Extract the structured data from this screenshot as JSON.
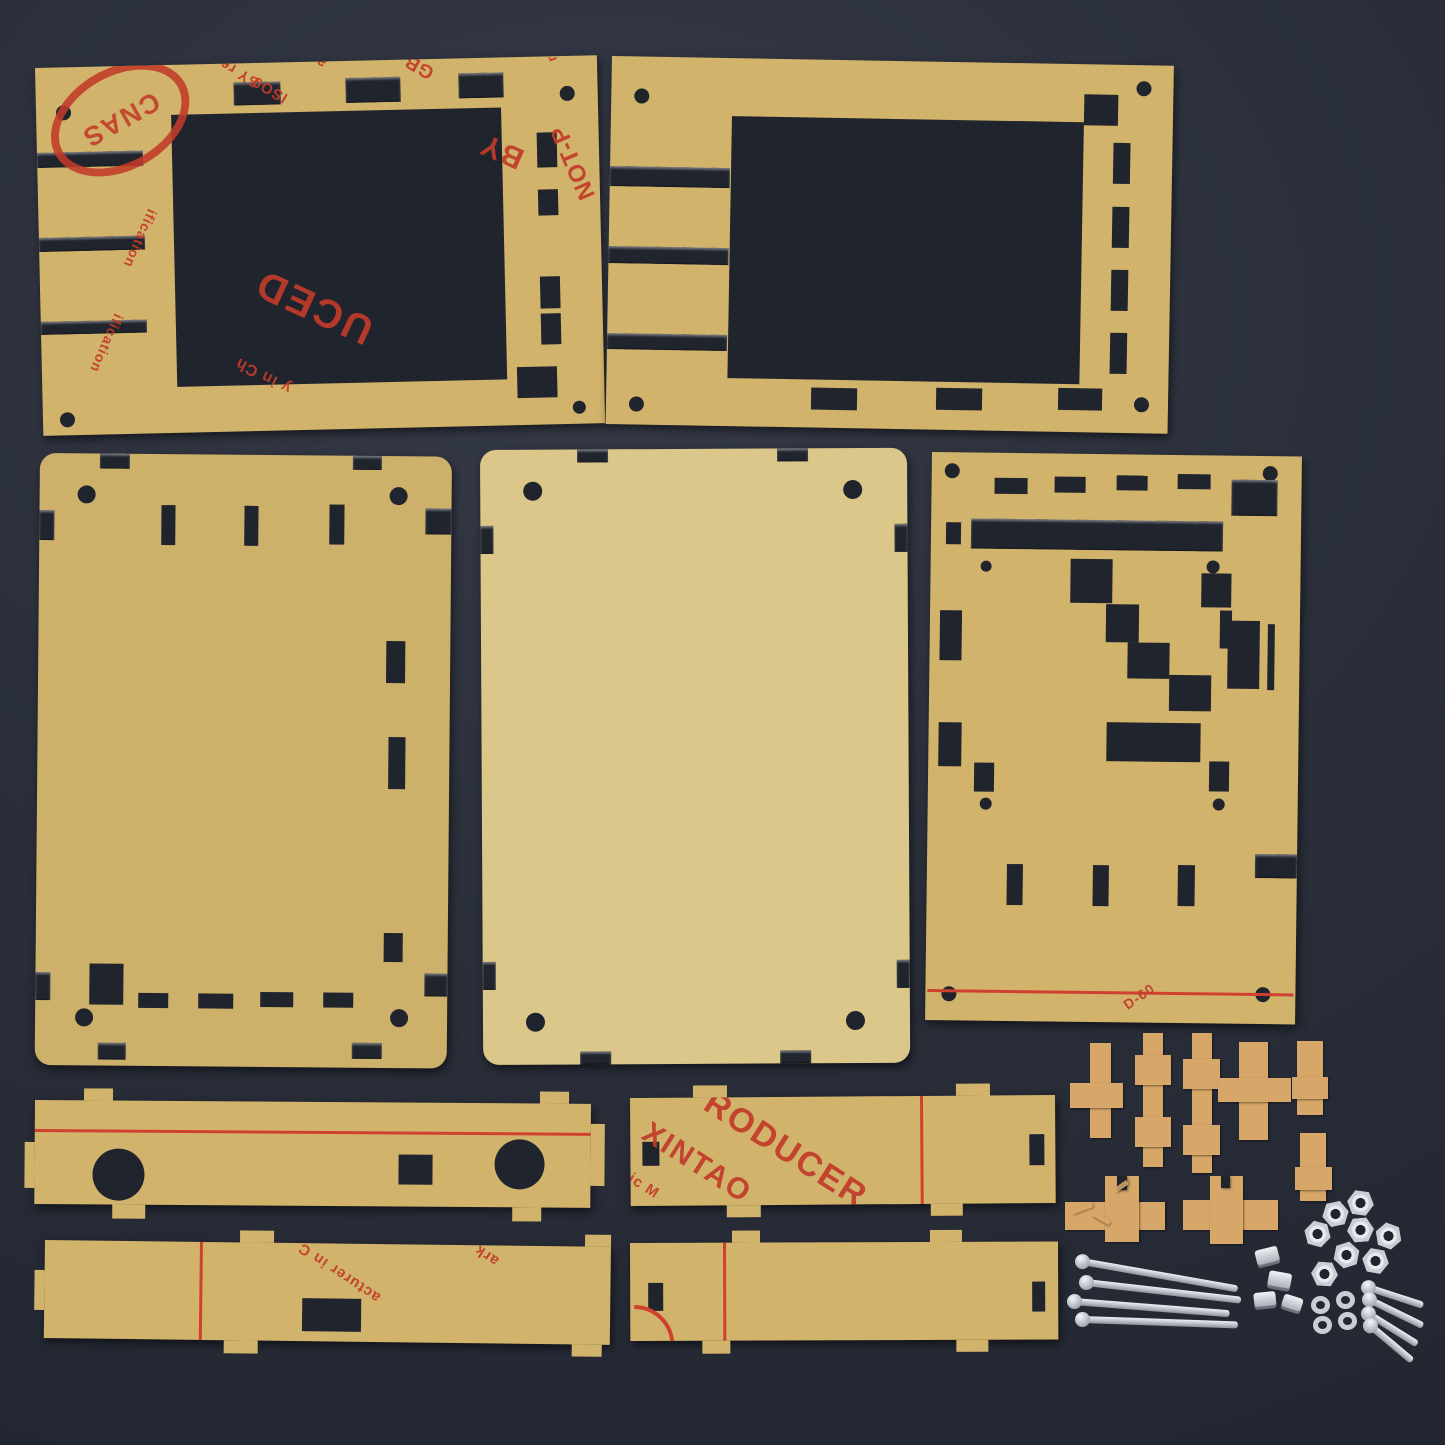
{
  "colors": {
    "bg": "#2a2f3a",
    "cut": "#20242d",
    "acrylic": "#d2b36b",
    "acrylic_light": "#dbc789",
    "acrylic_deep": "#cdb069",
    "clip": "#d6a768",
    "red": "#c23b2a",
    "line_red": "#d04030",
    "metal": "#c9cdd4",
    "green": "#43a050"
  },
  "prints": {
    "stamp": "CNAS",
    "f_ne": "ne Bigge",
    "f_agem": "agem",
    "f_sy": "SY re",
    "f_iso": "ISO9",
    "f_pag": "pag",
    "f_gb": "GB",
    "f_rovi": "rovi",
    "f_by": "BY",
    "f_notp": "NOT-P",
    "f_uced": "UCED",
    "f_ification": "ification",
    "f_inch": "y in Ch",
    "f_xintao": "XINTAO",
    "f_roducer": "RODUCER",
    "f_icm": "ic M",
    "f_acturer": "acturer in C",
    "f_ark": "ark",
    "f_d60": "D-60"
  },
  "hardware": {
    "long_screws": 4,
    "short_screws": 4,
    "hex_nuts_flat": 8,
    "hex_nuts_on_edge": 4,
    "washers": 4,
    "acrylic_clips": 8
  },
  "parts": {
    "front_bezel_printed": "front bezel (printed film)",
    "front_bezel_plain": "front bezel (plain film)",
    "base_plate": "base plate",
    "cover_plate": "cover plate",
    "back_plate": "back plate",
    "side_strip_bnc": "side strip with round ports",
    "side_strip_slot": "side strip with slot",
    "side_strip_xintao": "side strip (printed film)",
    "side_strip_plain": "side strip"
  }
}
